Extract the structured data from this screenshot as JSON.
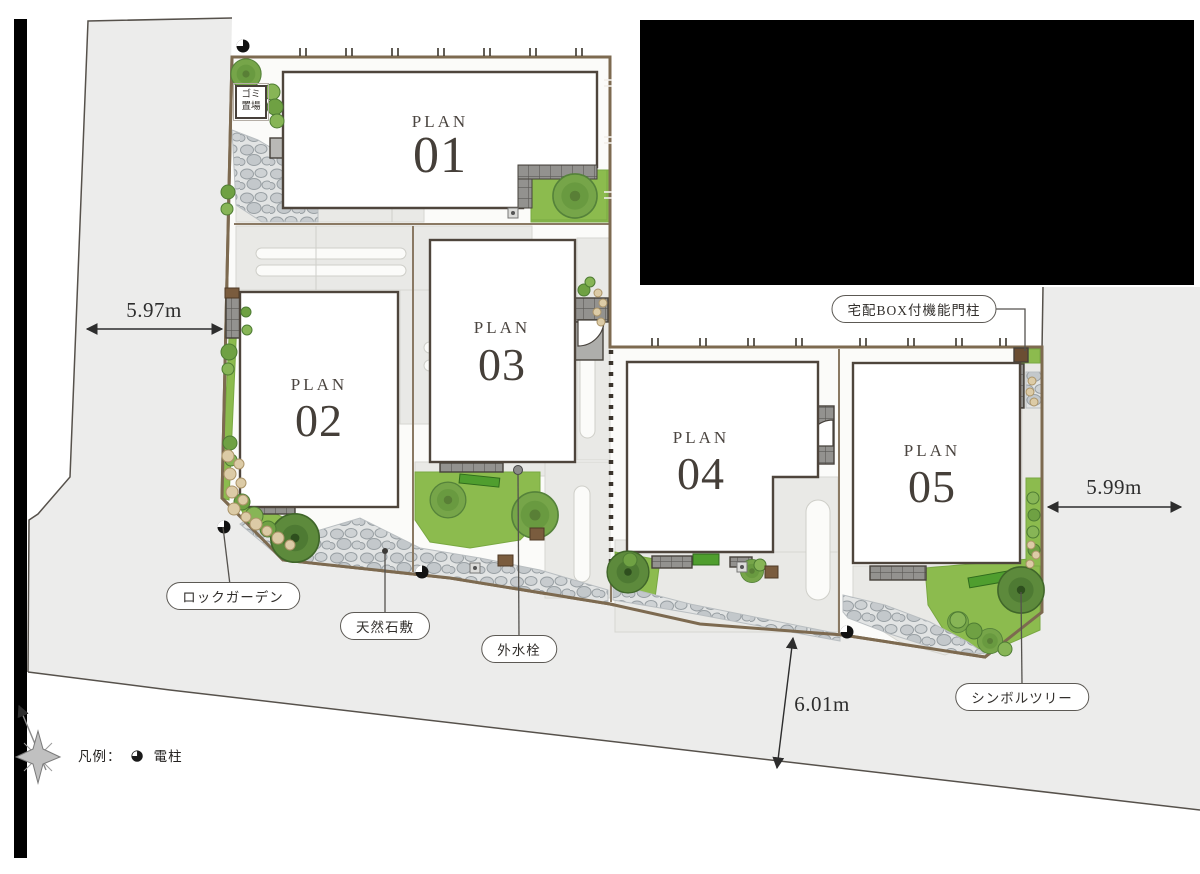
{
  "plans": [
    {
      "label": "PLAN",
      "number": "01"
    },
    {
      "label": "PLAN",
      "number": "02"
    },
    {
      "label": "PLAN",
      "number": "03"
    },
    {
      "label": "PLAN",
      "number": "04"
    },
    {
      "label": "PLAN",
      "number": "05"
    }
  ],
  "annotations": {
    "garbage_sign": {
      "line1": "ゴミ",
      "line2": "置場"
    },
    "delivery_box_pillar": "宅配BOX付機能門柱",
    "rock_garden": "ロックガーデン",
    "natural_stone_paving": "天然石敷",
    "outdoor_faucet": "外水栓",
    "symbol_tree": "シンボルツリー"
  },
  "measurements": {
    "west_road_width": "5.97m",
    "east_road_width": "5.99m",
    "south_road_width": "6.01m"
  },
  "legend": {
    "prefix": "凡例：",
    "pole_icon": "utility-pole-icon",
    "pole_glyph": "◕",
    "pole_label": "電柱"
  },
  "colors": {
    "road": "#ececeb",
    "site": "#fbfbf9",
    "boundary_brown": "#7d6a50",
    "grass": "#8cbb4e",
    "grass_dark": "#5d8a3c",
    "pebble": "#c7cbce",
    "tile_gray": "#93928f",
    "redaction": "#000000"
  }
}
